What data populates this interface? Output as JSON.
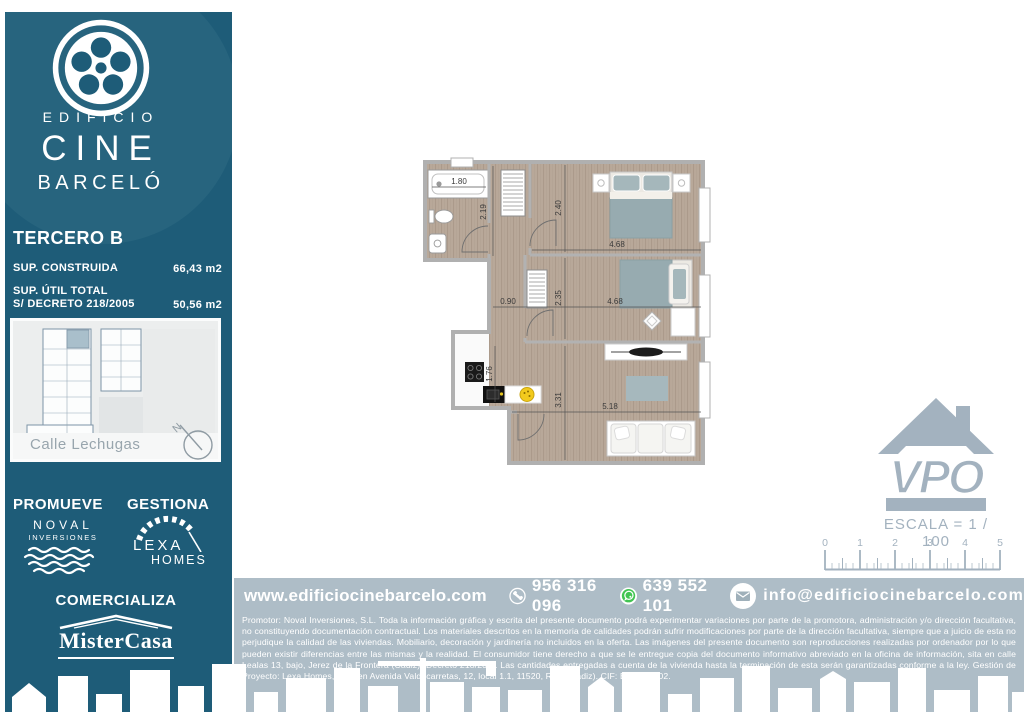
{
  "colors": {
    "sidebar_teal": "#1e5c78",
    "bar_gray": "#aebdc7",
    "scale_gray": "#a3b2bf",
    "whatsapp_green": "#41c452",
    "wood_floor": "#b8a899",
    "highlight_unit": "#a9bfcb"
  },
  "sidebar": {
    "brand": {
      "line1": "EDIFICIO",
      "line2": "CINE",
      "line3": "BARCELÓ"
    },
    "unit_title": "TERCERO B",
    "area1_label": "SUP. CONSTRUIDA",
    "area1_value": "66,43 m2",
    "area2_label1": "SUP. ÚTIL TOTAL",
    "area2_label2": "S/ DECRETO 218/2005",
    "area2_value": "50,56 m2",
    "siteplan_street": "Calle Lechugas",
    "compass": "N",
    "promueve_label": "PROMUEVE",
    "gestiona_label": "GESTIONA",
    "noval_line1": "NOVAL",
    "noval_line2": "INVERSIONES",
    "lexa_line1": "LEXA",
    "lexa_line2": "HOMES",
    "comercializa_label": "COMERCIALIZA",
    "mistercasa": "MisterCasa"
  },
  "floorplan": {
    "dims": {
      "bath_w": "1.80",
      "bath_h": "2.19",
      "bed1_h": "2.40",
      "bed1_w": "4.68",
      "hall_w": "0.90",
      "bed2_h": "2.35",
      "bed2_w": "4.68",
      "kitchen_h": "1.76",
      "living_h": "3.31",
      "living_w": "5.18"
    }
  },
  "scale_block": {
    "vpo": "VPO",
    "escala_label": "ESCALA = 1 / 100",
    "ruler": [
      "0",
      "1",
      "2",
      "3",
      "4",
      "5"
    ]
  },
  "contact": {
    "website": "www.edificiocinebarcelo.com",
    "phone": "956 316 096",
    "whatsapp": "639 552 101",
    "email": "info@edificiocinebarcelo.com"
  },
  "legal_text": "Promotor: Noval Inversiones, S.L. Toda la información gráfica y escrita del presente documento podrá experimentar variaciones por parte de la promotora, administración y/o dirección facultativa, no constituyendo documentación contractual. Los materiales descritos en la memoria de calidades podrán sufrir modificaciones por parte de la dirección facultativa, siempre que a juicio de esta no perjudique la calidad de las viviendas. Mobiliario, decoración y jardinería no incluidos en la oferta. Las imágenes del presente documento son reproducciones realizadas por ordenador por lo que pueden existir diferencias entre las mismas y la realidad. El consumidor tiene derecho a que se le entregue copia del documento informativo abreviado en la oficina de información, sita en calle Lealas 13, bajo, Jerez de la Frontera (Cádiz) (Decreto 218/200). Las cantidades entregadas a cuenta de la vivienda hasta la terminación de esta serán garantizadas conforme a la ley. Gestión de Proyecto: Lexa Homes, S.L., en Avenida Valdecarretas, 12, local 1.1, 11520, Rota (Cádiz). CIF: B-72206402."
}
